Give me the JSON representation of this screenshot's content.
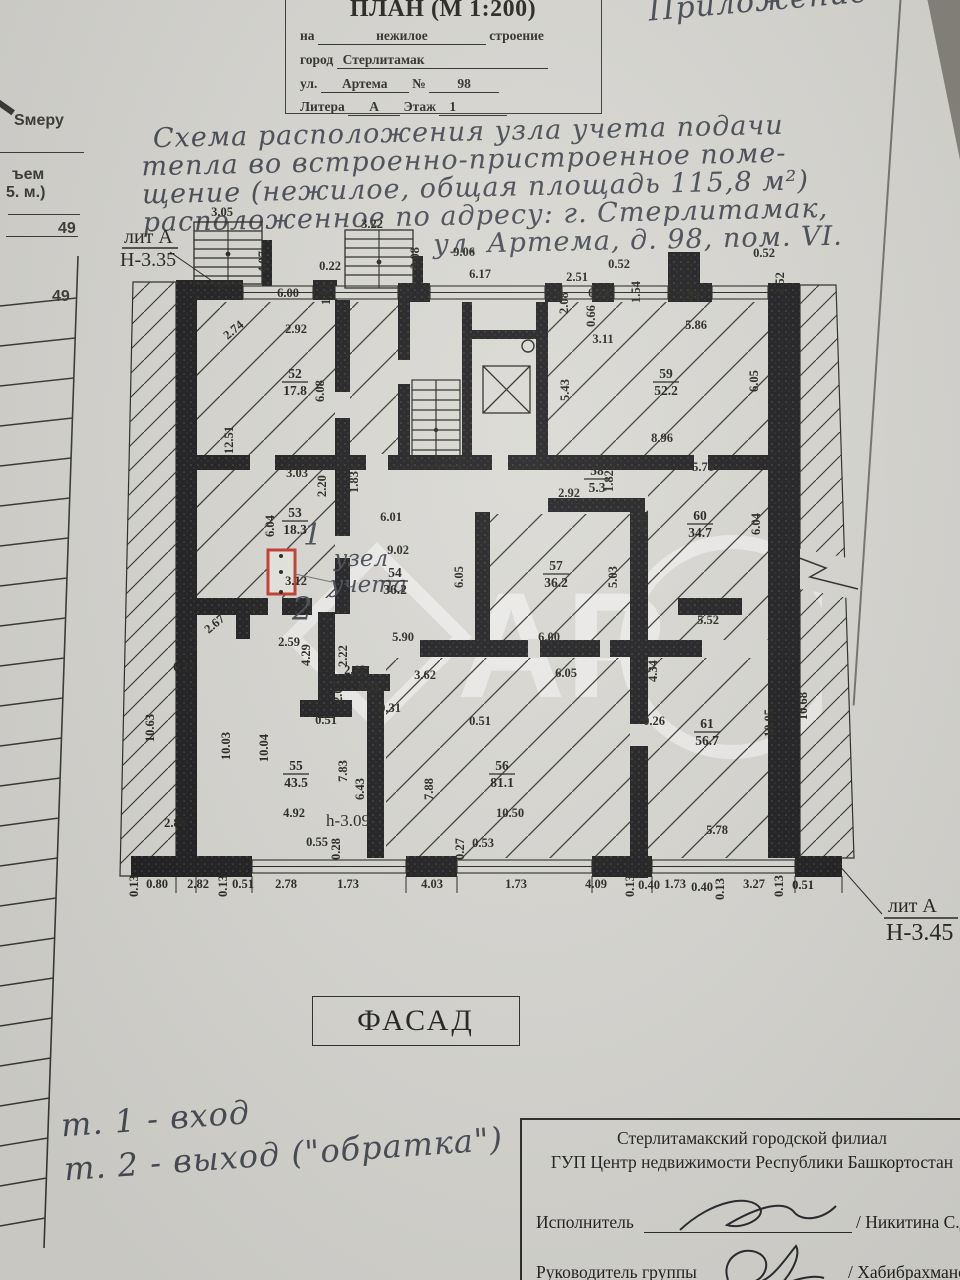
{
  "header_form": {
    "title": "ПЛАН (М 1:200)",
    "row1_label": "на",
    "row1_value": "нежилое",
    "row1_suffix": "строение",
    "row2_label": "город",
    "row2_value": "Стерлитамак",
    "row3_label": "ул.",
    "row3_value": "Артема",
    "row3_no_label": "№",
    "row3_no_value": "98",
    "row4_label": "Литера",
    "row4_value": "А",
    "row4_label2": "Этаж",
    "row4_value2": "1"
  },
  "corner_note": "Приложение",
  "handwritten_note": {
    "line1": "Схема расположения узла учета подачи",
    "line2": "тепла во встроенно-пристроенное поме-",
    "line3": "щение (нежилое, общая площадь 115,8 м²)",
    "line4": "расположенное по адресу: г. Стерлитамак,",
    "line5": "ул. Артема, д. 98, пом. VI."
  },
  "left_margin": {
    "texts": [
      {
        "t": "Ѕмеру",
        "x": 14,
        "y": 112
      },
      {
        "t": "ъем",
        "x": 12,
        "y": 166
      },
      {
        "t": "5. м.)",
        "x": 6,
        "y": 184
      },
      {
        "t": "49",
        "x": 58,
        "y": 220
      },
      {
        "t": "49",
        "x": 52,
        "y": 288
      }
    ]
  },
  "plan": {
    "lit_top_1": "лит А",
    "lit_top_2": "Н-3.35",
    "lit_bottom_1": "лит А",
    "lit_bottom_2": "Н-3.45",
    "point_1": "1",
    "point_2": "2",
    "unit_line1": "узел",
    "unit_line2": "учета",
    "height_mark": "h-3.09",
    "rooms": [
      {
        "num": "52",
        "area": "17.8",
        "x": 295,
        "y": 378
      },
      {
        "num": "53",
        "area": "18.3",
        "x": 295,
        "y": 517
      },
      {
        "num": "54",
        "area": "36.2",
        "x": 395,
        "y": 577
      },
      {
        "num": "55",
        "area": "43.5",
        "x": 296,
        "y": 770
      },
      {
        "num": "56",
        "area": "81.1",
        "x": 502,
        "y": 770
      },
      {
        "num": "57",
        "area": "36.2",
        "x": 556,
        "y": 570
      },
      {
        "num": "58",
        "area": "5.3",
        "x": 597,
        "y": 475
      },
      {
        "num": "59",
        "area": "52.2",
        "x": 666,
        "y": 378
      },
      {
        "num": "60",
        "area": "34.7",
        "x": 700,
        "y": 520
      },
      {
        "num": "61",
        "area": "56.7",
        "x": 707,
        "y": 728
      }
    ],
    "dims": [
      {
        "t": "3.05",
        "x": 222,
        "y": 216
      },
      {
        "t": "4.07",
        "x": 267,
        "y": 262,
        "r": 90
      },
      {
        "t": "3.22",
        "x": 372,
        "y": 228
      },
      {
        "t": "3.08",
        "x": 419,
        "y": 258,
        "r": 90
      },
      {
        "t": "9.06",
        "x": 464,
        "y": 256
      },
      {
        "t": "0.22",
        "x": 330,
        "y": 270
      },
      {
        "t": "6.17",
        "x": 480,
        "y": 278
      },
      {
        "t": "2.51",
        "x": 577,
        "y": 281
      },
      {
        "t": "0.52",
        "x": 619,
        "y": 268
      },
      {
        "t": "2.08",
        "x": 568,
        "y": 303,
        "r": 90
      },
      {
        "t": "0.24",
        "x": 599,
        "y": 297
      },
      {
        "t": "0.66",
        "x": 595,
        "y": 316,
        "r": 90
      },
      {
        "t": "1.54",
        "x": 640,
        "y": 292,
        "r": 90
      },
      {
        "t": "5.99",
        "x": 689,
        "y": 299
      },
      {
        "t": "0.52",
        "x": 764,
        "y": 257
      },
      {
        "t": "1.52",
        "x": 784,
        "y": 283,
        "r": 90
      },
      {
        "t": "6.00",
        "x": 288,
        "y": 297
      },
      {
        "t": "1.52",
        "x": 330,
        "y": 294,
        "r": 90
      },
      {
        "t": "2.74",
        "x": 236,
        "y": 333,
        "r": 40
      },
      {
        "t": "2.92",
        "x": 296,
        "y": 333
      },
      {
        "t": "3.11",
        "x": 603,
        "y": 343
      },
      {
        "t": "5.86",
        "x": 696,
        "y": 329
      },
      {
        "t": "5.43",
        "x": 569,
        "y": 390,
        "r": 90
      },
      {
        "t": "6.05",
        "x": 758,
        "y": 381,
        "r": 90
      },
      {
        "t": "6.08",
        "x": 324,
        "y": 391,
        "r": 90
      },
      {
        "t": "12.51",
        "x": 233,
        "y": 440,
        "r": 90
      },
      {
        "t": "8.96",
        "x": 662,
        "y": 442
      },
      {
        "t": "5.76",
        "x": 703,
        "y": 471
      },
      {
        "t": "3.03",
        "x": 297,
        "y": 477
      },
      {
        "t": "2.20",
        "x": 326,
        "y": 486,
        "r": 90
      },
      {
        "t": "1.83",
        "x": 358,
        "y": 482,
        "r": 90
      },
      {
        "t": "2.92",
        "x": 569,
        "y": 497
      },
      {
        "t": "1.82",
        "x": 613,
        "y": 481,
        "r": 90
      },
      {
        "t": "6.01",
        "x": 391,
        "y": 521
      },
      {
        "t": "6.02",
        "x": 648,
        "y": 521,
        "r": 90
      },
      {
        "t": "6.04",
        "x": 274,
        "y": 526,
        "r": 90
      },
      {
        "t": "9.02",
        "x": 398,
        "y": 554
      },
      {
        "t": "6.05",
        "x": 463,
        "y": 577,
        "r": 90
      },
      {
        "t": "6.04",
        "x": 760,
        "y": 524,
        "r": 90
      },
      {
        "t": "5.03",
        "x": 617,
        "y": 577,
        "r": 90
      },
      {
        "t": "2.16",
        "x": 197,
        "y": 640,
        "r": 90
      },
      {
        "t": "2.67",
        "x": 217,
        "y": 627,
        "r": 40
      },
      {
        "t": "0.13",
        "x": 184,
        "y": 671
      },
      {
        "t": "2.59",
        "x": 289,
        "y": 646
      },
      {
        "t": "3.12",
        "x": 296,
        "y": 585
      },
      {
        "t": "2.22",
        "x": 347,
        "y": 656,
        "r": 90
      },
      {
        "t": "4.29",
        "x": 310,
        "y": 655,
        "r": 90
      },
      {
        "t": "2.12",
        "x": 355,
        "y": 674
      },
      {
        "t": "2.07",
        "x": 342,
        "y": 692,
        "r": 90
      },
      {
        "t": "0.31",
        "x": 369,
        "y": 691
      },
      {
        "t": "3.62",
        "x": 425,
        "y": 679
      },
      {
        "t": "5.90",
        "x": 403,
        "y": 641
      },
      {
        "t": "6.00",
        "x": 549,
        "y": 641
      },
      {
        "t": "6.05",
        "x": 566,
        "y": 677
      },
      {
        "t": "0.31",
        "x": 390,
        "y": 712
      },
      {
        "t": "0.51",
        "x": 326,
        "y": 724
      },
      {
        "t": "0.51",
        "x": 480,
        "y": 725
      },
      {
        "t": "5.52",
        "x": 708,
        "y": 624
      },
      {
        "t": "10.03",
        "x": 230,
        "y": 746,
        "r": 90
      },
      {
        "t": "10.04",
        "x": 268,
        "y": 748,
        "r": 90
      },
      {
        "t": "10.63",
        "x": 154,
        "y": 728,
        "r": 90
      },
      {
        "t": "7.83",
        "x": 347,
        "y": 771,
        "r": 90
      },
      {
        "t": "6.43",
        "x": 364,
        "y": 789,
        "r": 90
      },
      {
        "t": "7.88",
        "x": 433,
        "y": 789,
        "r": 90
      },
      {
        "t": "10.50",
        "x": 510,
        "y": 817
      },
      {
        "t": "2.80",
        "x": 175,
        "y": 827
      },
      {
        "t": "4.92",
        "x": 294,
        "y": 817
      },
      {
        "t": "0.55",
        "x": 317,
        "y": 846
      },
      {
        "t": "0.28",
        "x": 340,
        "y": 849,
        "r": 90
      },
      {
        "t": "0.27",
        "x": 464,
        "y": 849,
        "r": 90
      },
      {
        "t": "0.53",
        "x": 483,
        "y": 847
      },
      {
        "t": "4.34",
        "x": 657,
        "y": 671,
        "r": 90
      },
      {
        "t": "0.26",
        "x": 654,
        "y": 725
      },
      {
        "t": "10.05",
        "x": 773,
        "y": 723,
        "r": 90
      },
      {
        "t": "10.68",
        "x": 807,
        "y": 706,
        "r": 90
      },
      {
        "t": "5.78",
        "x": 717,
        "y": 834
      },
      {
        "t": "0.13",
        "x": 138,
        "y": 886,
        "r": 90
      },
      {
        "t": "0.80",
        "x": 157,
        "y": 888
      },
      {
        "t": "2.82",
        "x": 198,
        "y": 888
      },
      {
        "t": "0.13",
        "x": 227,
        "y": 886,
        "r": 90
      },
      {
        "t": "0.51",
        "x": 243,
        "y": 888
      },
      {
        "t": "2.78",
        "x": 286,
        "y": 888
      },
      {
        "t": "1.73",
        "x": 348,
        "y": 888
      },
      {
        "t": "4.03",
        "x": 432,
        "y": 888
      },
      {
        "t": "1.73",
        "x": 516,
        "y": 888
      },
      {
        "t": "4.09",
        "x": 596,
        "y": 888
      },
      {
        "t": "0.13",
        "x": 634,
        "y": 886,
        "r": 90
      },
      {
        "t": "0.40",
        "x": 649,
        "y": 889
      },
      {
        "t": "1.73",
        "x": 675,
        "y": 888
      },
      {
        "t": "0.40",
        "x": 702,
        "y": 891
      },
      {
        "t": "0.13",
        "x": 724,
        "y": 889,
        "r": 90
      },
      {
        "t": "3.27",
        "x": 754,
        "y": 888
      },
      {
        "t": "0.13",
        "x": 783,
        "y": 886,
        "r": 90
      },
      {
        "t": "0.51",
        "x": 803,
        "y": 889
      }
    ]
  },
  "facade": {
    "label": "ФАСАД"
  },
  "handwritten_legend": {
    "line1": "т. 1 - вход",
    "line2": "т. 2 - выход (\"обратка\")"
  },
  "footer": {
    "org_line1": "Стерлитамакский городской филиал",
    "org_line2": "ГУП Центр недвижимости Республики Башкортостан",
    "executor_label": "Исполнитель",
    "executor_name": "/ Никитина С.Д./",
    "manager_label": "Руководитель группы",
    "manager_name": "/ Хабибрахманова А.",
    "cut_line": "ТЕХНИЧЕСКАЯ ИНВЕНТАРИЗАЦИЯ"
  },
  "watermark": {
    "letters": "АР"
  }
}
